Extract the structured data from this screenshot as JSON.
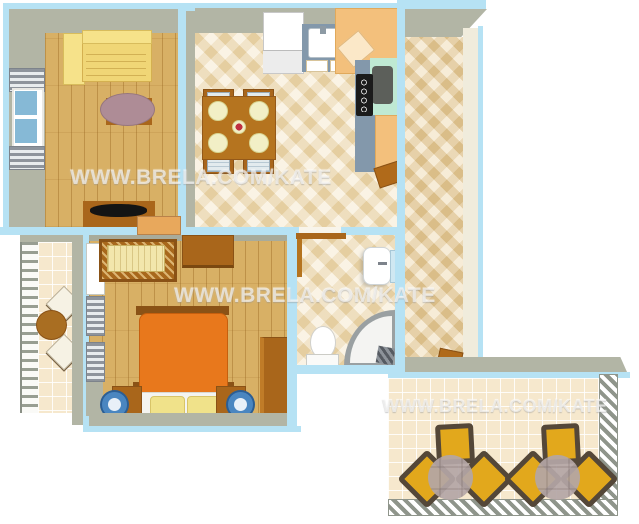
{
  "watermarks": [
    {
      "text": "WWW.BRELA.COM/KATE"
    },
    {
      "text": "WWW.BRELA.COM/KATE"
    },
    {
      "text": "WWW.BRELA.COM/KATE"
    }
  ],
  "colors": {
    "wall_outline": "#b6e2f4",
    "wall": "#b2b5a5",
    "wood_floor": "#d8b065",
    "tile_cream": "#f3e4c2",
    "tile_dark": "#eed9ae",
    "tile_terrace": "#f6e8cd",
    "counter_gray": "#8398ab",
    "counter_tan": "#f3c07c",
    "counter_mint": "#bfe9d3",
    "sofa_yellow": "#f0d676",
    "bed_orange": "#e8781c",
    "furniture_brown": "#a9661b",
    "chair_yellow": "#e2a81c",
    "stool_blue": "#4a86c0",
    "watermark": "rgba(255,255,255,0.62)"
  }
}
